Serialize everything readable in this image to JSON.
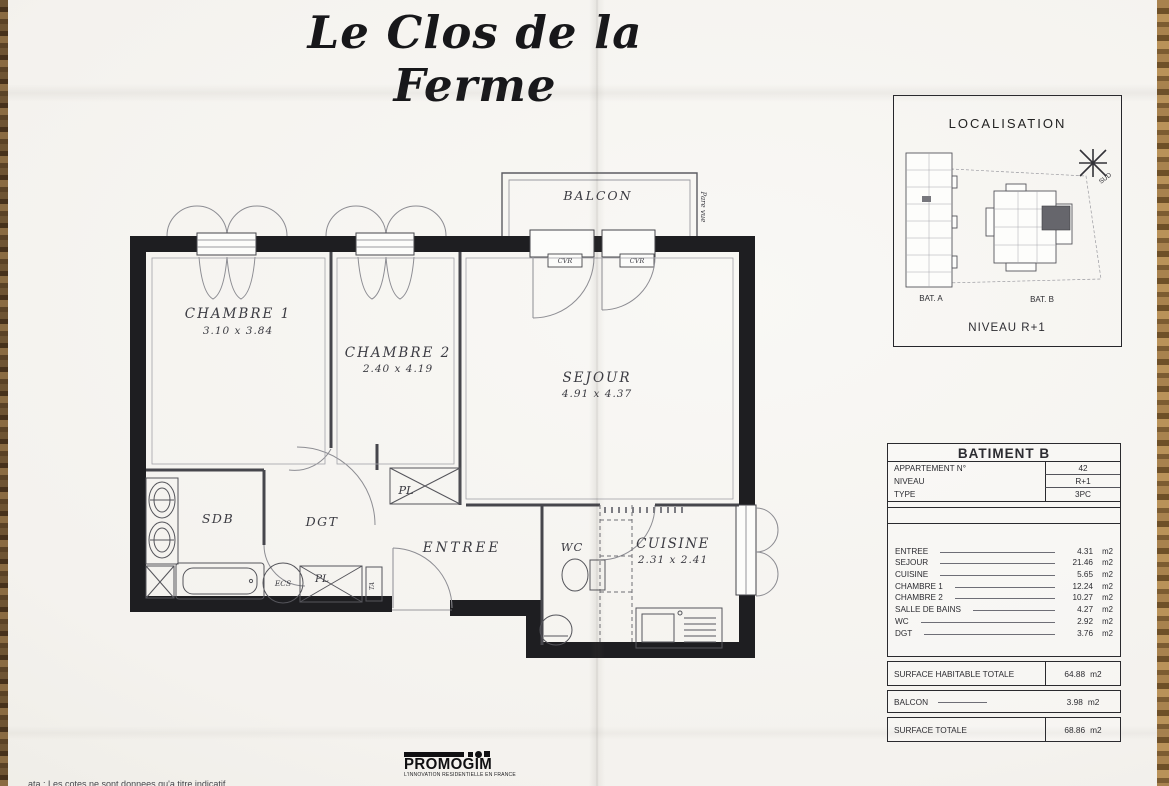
{
  "doc": {
    "title": "Le Clos de la Ferme"
  },
  "plan": {
    "balcon": "BALCON",
    "pare_vue": "Pare vue",
    "cvr": "CVR",
    "chambre1": {
      "name": "CHAMBRE 1",
      "dims": "3.10 x 3.84"
    },
    "chambre2": {
      "name": "CHAMBRE 2",
      "dims": "2.40 x 4.19"
    },
    "sejour": {
      "name": "SEJOUR",
      "dims": "4.91 x 4.37"
    },
    "sdb": "SDB",
    "dgt": "DGT",
    "pl_upper": "PL",
    "pl_lower": "PL",
    "ecs": "ECS",
    "ta": "TA",
    "entree": "ENTREE",
    "wc": "WC",
    "cuisine": {
      "name": "CUISINE",
      "dims": "2.31 x 2.41"
    }
  },
  "localisation": {
    "title": "LOCALISATION",
    "bat_a": "BAT. A",
    "bat_b": "BAT. B",
    "niveau": "NIVEAU R+1",
    "compass": "SUD"
  },
  "table": {
    "title": "BATIMENT B",
    "info": [
      {
        "label": "APPARTEMENT N°",
        "value": "42"
      },
      {
        "label": "NIVEAU",
        "value": "R+1"
      },
      {
        "label": "TYPE",
        "value": "3PC"
      }
    ],
    "rooms": [
      {
        "label": "ENTREE",
        "value": "4.31",
        "unit": "m2"
      },
      {
        "label": "SEJOUR",
        "value": "21.46",
        "unit": "m2"
      },
      {
        "label": "CUISINE",
        "value": "5.65",
        "unit": "m2"
      },
      {
        "label": "CHAMBRE 1",
        "value": "12.24",
        "unit": "m2"
      },
      {
        "label": "CHAMBRE 2",
        "value": "10.27",
        "unit": "m2"
      },
      {
        "label": "SALLE DE BAINS",
        "value": "4.27",
        "unit": "m2"
      },
      {
        "label": "WC",
        "value": "2.92",
        "unit": "m2"
      },
      {
        "label": "DGT",
        "value": "3.76",
        "unit": "m2"
      }
    ],
    "totals": {
      "habitable": {
        "label": "SURFACE HABITABLE TOTALE",
        "value": "64.88",
        "unit": "m2"
      },
      "balcon": {
        "label": "BALCON",
        "value": "3.98",
        "unit": "m2"
      },
      "totale": {
        "label": "SURFACE TOTALE",
        "value": "68.86",
        "unit": "m2"
      }
    }
  },
  "footer": {
    "brand": "PROMOGIM",
    "tagline": "L'INNOVATION RESIDENTIELLE EN FRANCE",
    "note_fragment": "ata : Les cotes ne sont donnees qu'a titre indicatif"
  }
}
